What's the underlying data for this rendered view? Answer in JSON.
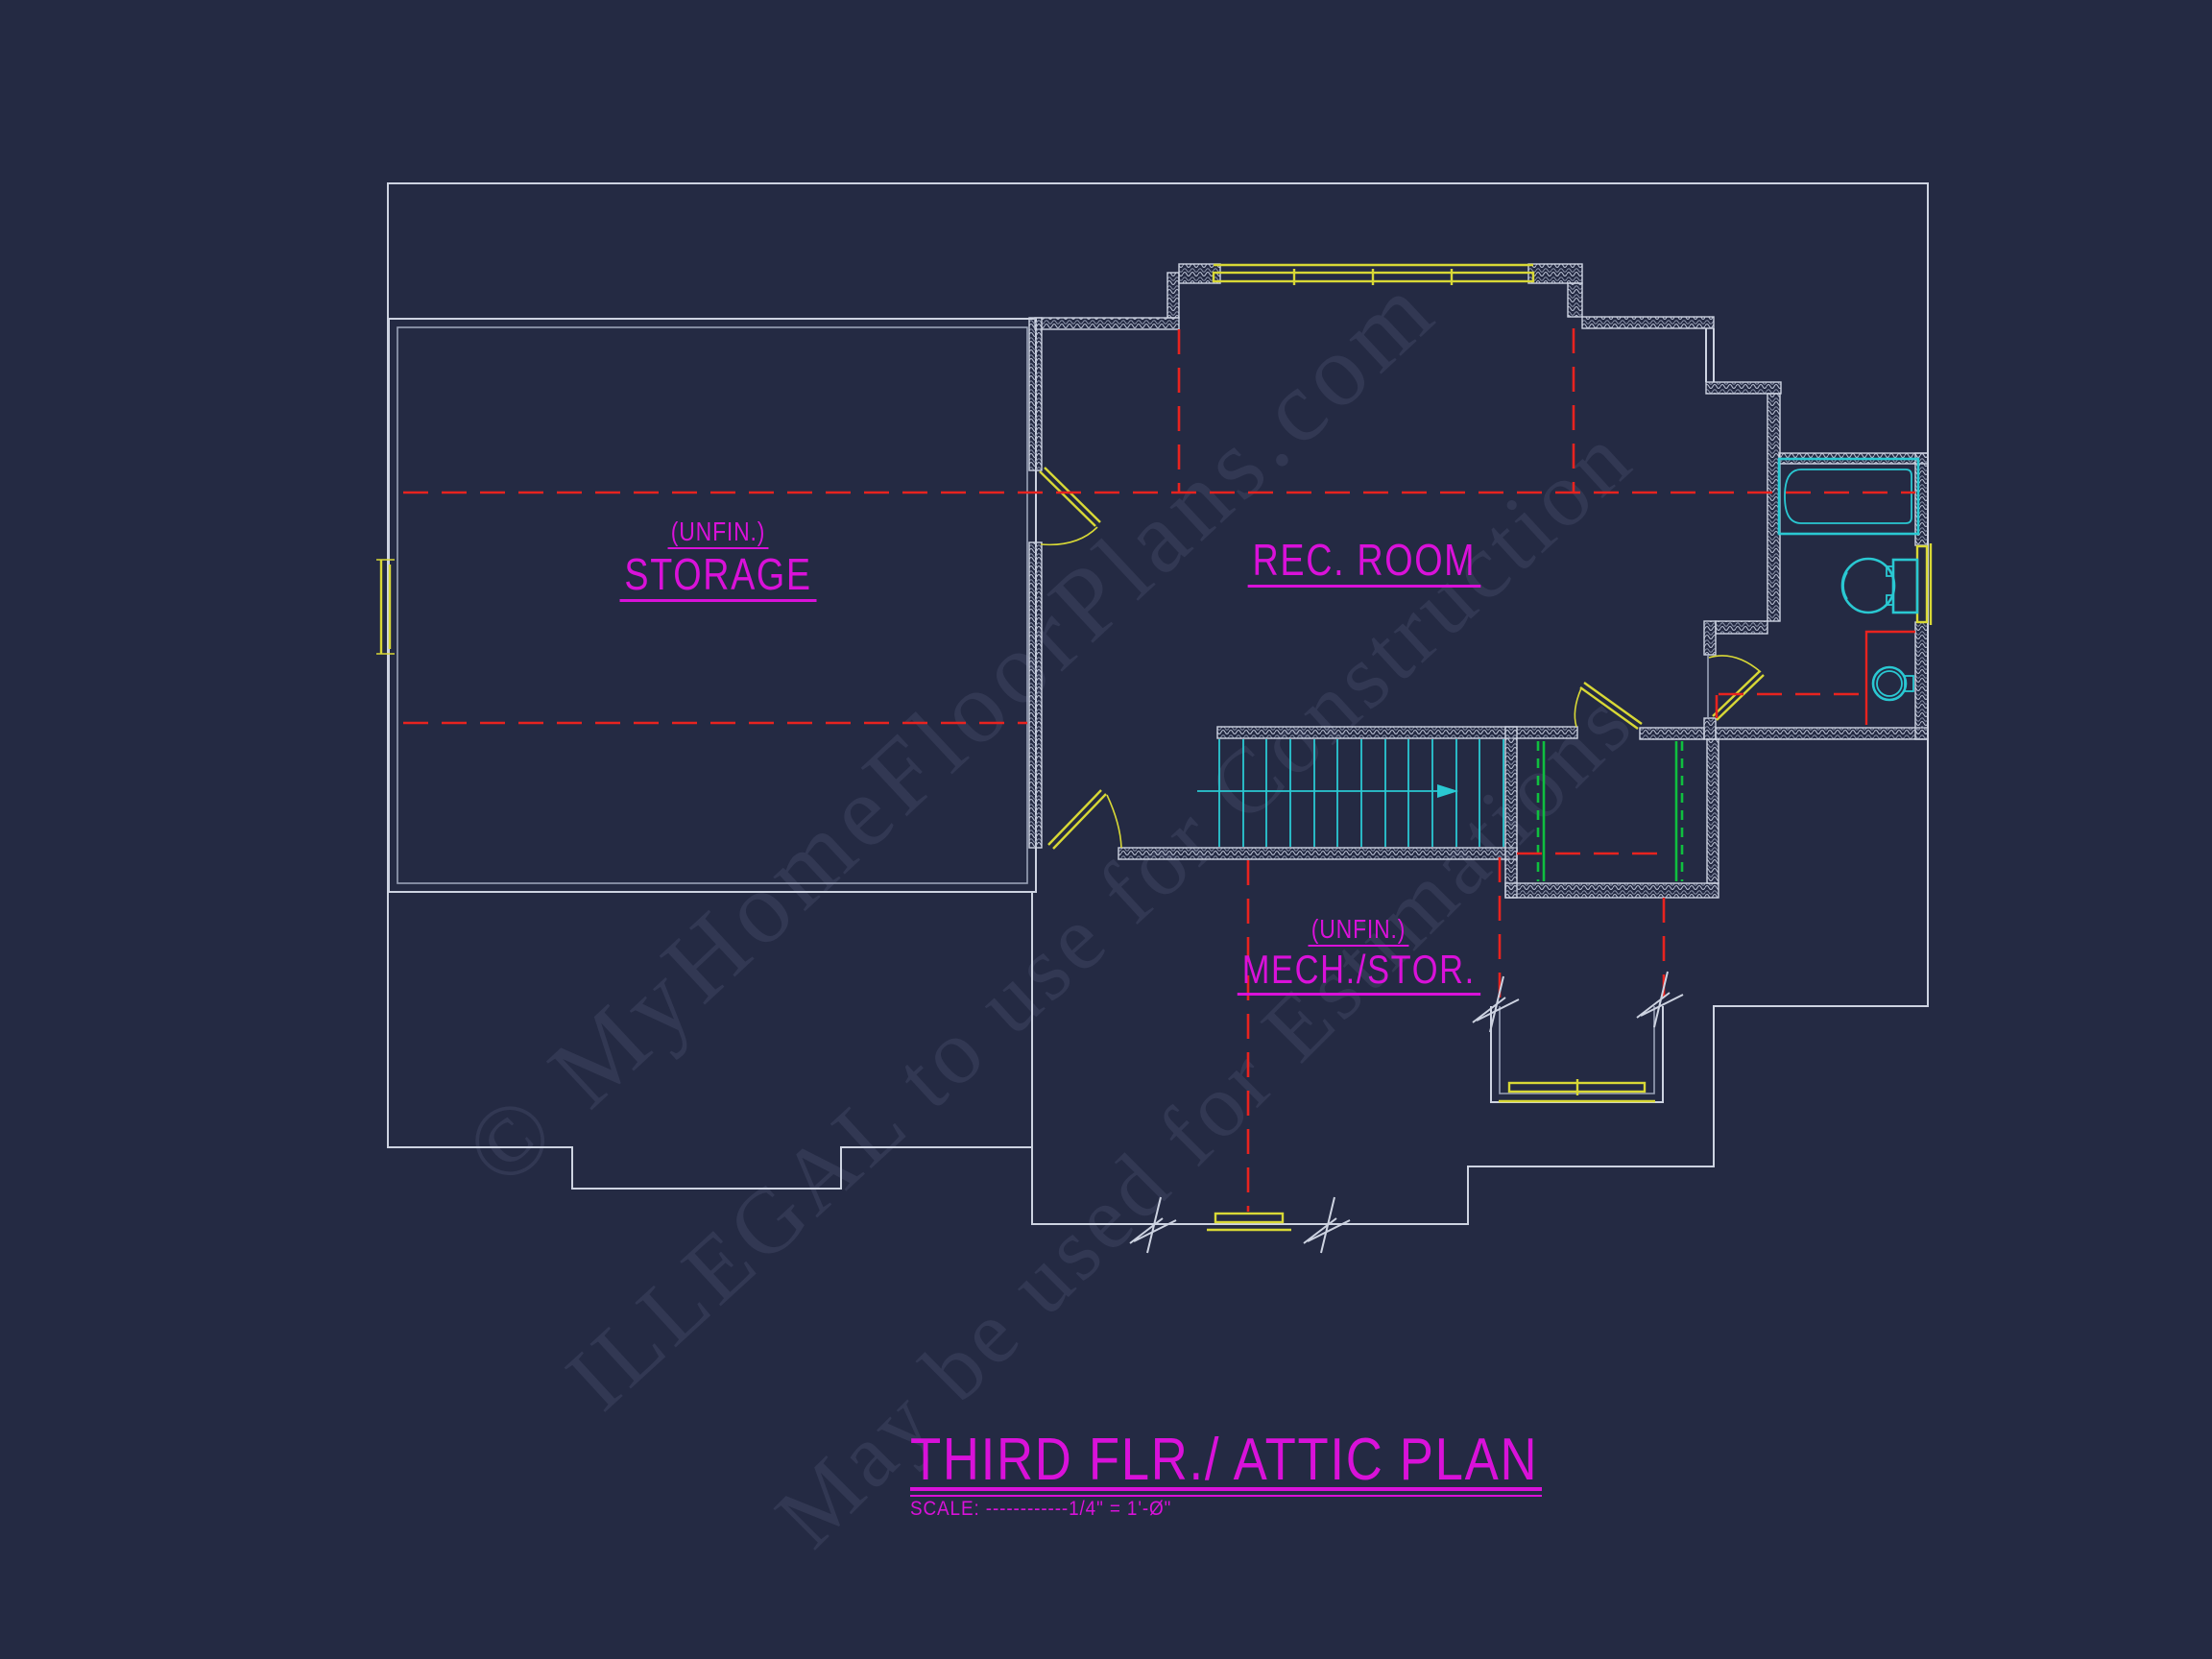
{
  "palette": {
    "bg": "#242a43",
    "wall": "#cdd3e1",
    "wall-dim": "#9aa2b8",
    "magenta": "#d911d9",
    "red": "#e8231f",
    "yellow": "#d8d836",
    "cyan": "#2ac8d2",
    "green": "#0fbf3f",
    "watermark": "rgba(154,164,202,0.12)"
  },
  "watermark": {
    "line1": "© MyHomeFloorPlans.com",
    "line2": "ILLEGAL to use for Construction",
    "line3": "May be used for Estimations"
  },
  "rooms": {
    "storage": {
      "prefix": "(UNFIN.)",
      "name": "STORAGE"
    },
    "rec": {
      "name": "REC. ROOM"
    },
    "mech": {
      "prefix": "(UNFIN.)",
      "name": "MECH./STOR."
    }
  },
  "title_block": {
    "title": "THIRD FLR./ ATTIC PLAN",
    "scale": "SCALE: ------------1/4\" = 1'-Ø\""
  }
}
